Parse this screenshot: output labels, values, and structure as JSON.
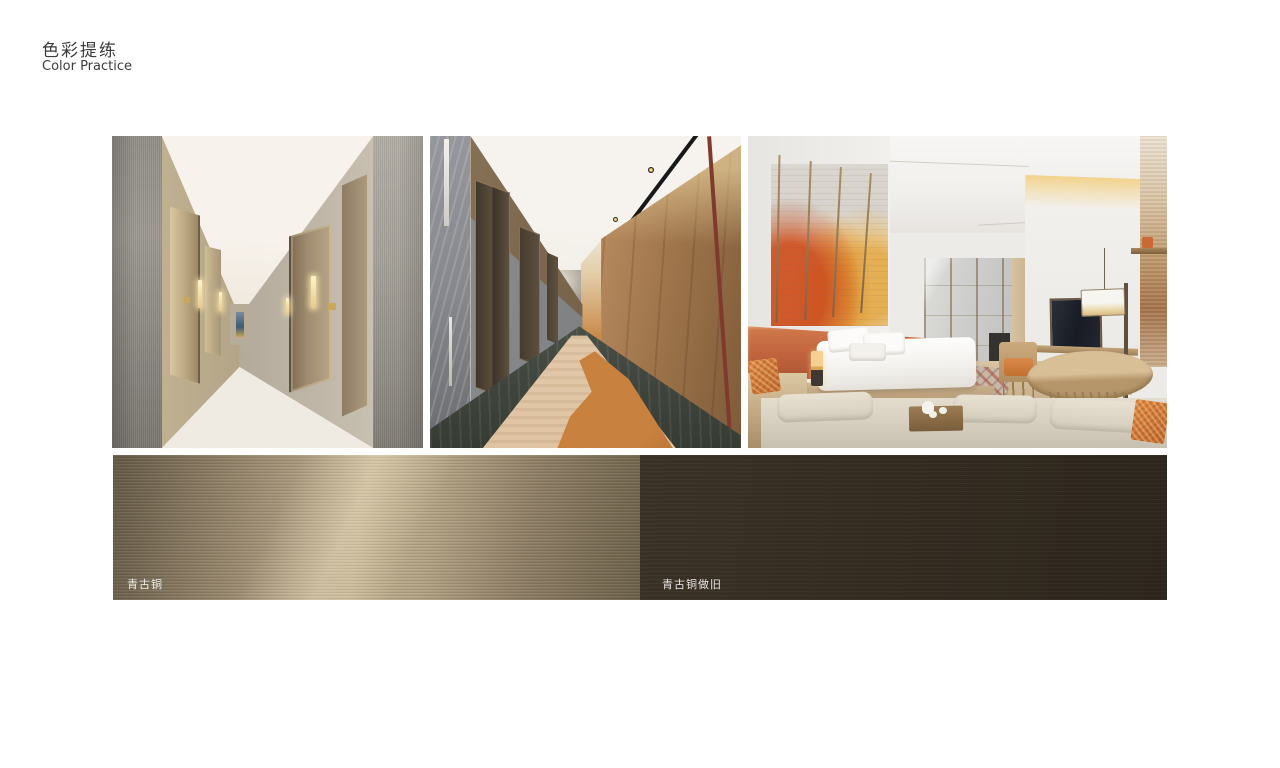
{
  "page": {
    "title_zh": "色彩提练",
    "title_en": "Color Practice",
    "background": "#ffffff"
  },
  "swatches": [
    {
      "label": "青古铜",
      "base_color": "#8a7a61",
      "highlight_color": "#c3b292"
    },
    {
      "label": "青古铜做旧",
      "base_color": "#332b20"
    }
  ],
  "palette": {
    "accent_orange": "#c2653f",
    "carpet_rust": "#bb7a3d",
    "bronze": "#8a7a61",
    "dark_bronze": "#332b20",
    "warm_wood": "#c39468",
    "wall_grey": "#9b9790"
  }
}
